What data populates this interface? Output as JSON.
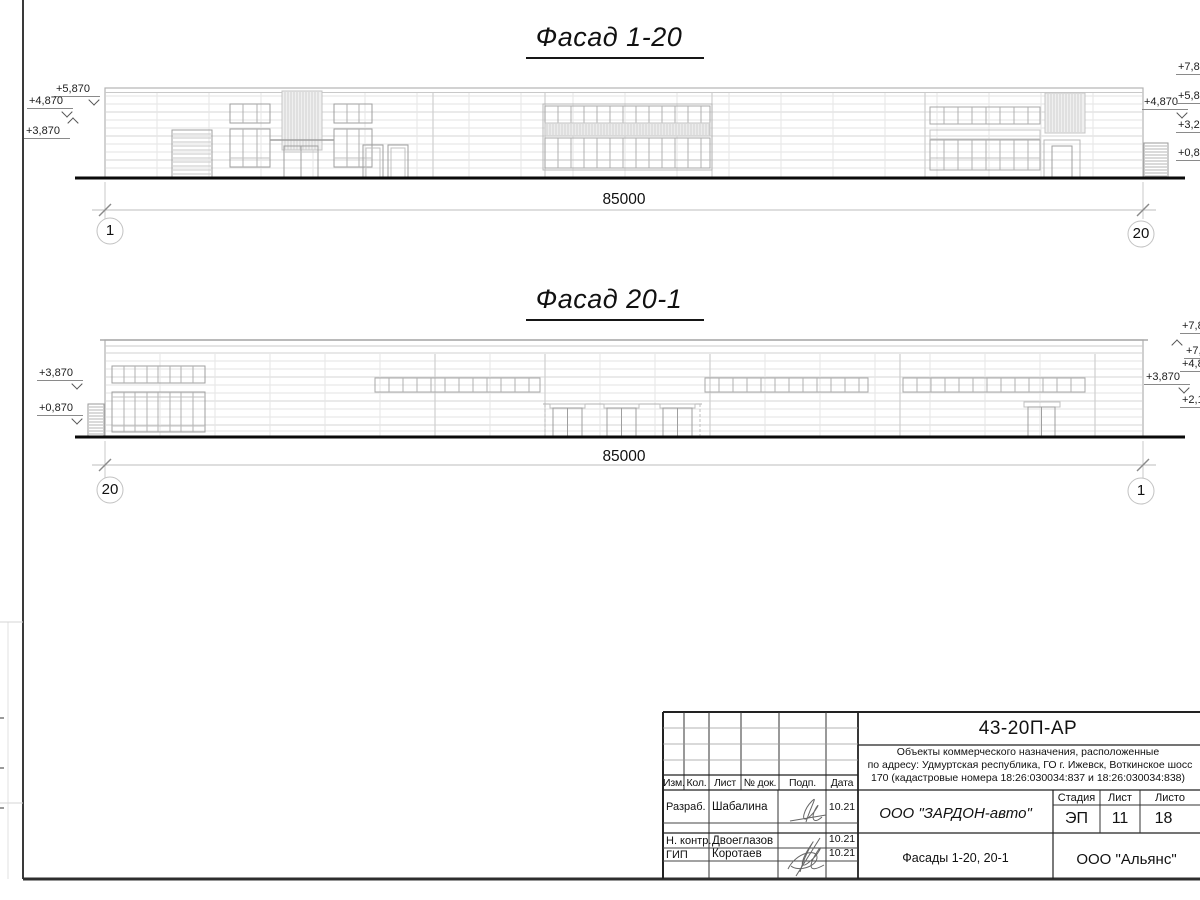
{
  "sheet": {
    "facade1": {
      "title": "Фасад 1-20",
      "dimension": "85000",
      "axis_left": "1",
      "axis_right": "20",
      "marks_left": [
        "+5,870",
        "+4,870",
        "+3,870"
      ],
      "mark_inner_right": "+4,870",
      "marks_right": [
        "+7,87",
        "+5,87",
        "+3,27",
        "+0,87"
      ]
    },
    "facade2": {
      "title": "Фасад 20-1",
      "dimension": "85000",
      "axis_left": "20",
      "axis_right": "1",
      "marks_left": [
        "+3,870",
        "+0,870"
      ],
      "mark_inner_right": "+3,870",
      "marks_right": [
        "+7,8",
        "+7,",
        "+4,8",
        "+2,1"
      ]
    },
    "titleblock": {
      "doc_number": "43-20П-АР",
      "project_lines": [
        "Объекты коммерческого назначения, расположенные",
        "по адресу: Удмуртская республика, ГО г. Ижевск, Воткинское шосс",
        "170 (кадастровые номера 18:26:030034:837 и 18:26:030034:838)"
      ],
      "columns": [
        "Изм.",
        "Кол.",
        "Лист",
        "№ док.",
        "Подп.",
        "Дата"
      ],
      "rows": [
        {
          "role": "Разраб.",
          "name": "Шабалина",
          "date": "10.21"
        },
        {
          "role": "Н. контр.",
          "name": "Двоеглазов",
          "date": "10.21"
        },
        {
          "role": "ГИП",
          "name": "Коротаев",
          "date": "10.21"
        }
      ],
      "company": "ООО \"ЗАРДОН-авто\"",
      "sheet_name": "Фасады 1-20, 20-1",
      "stage_label": "Стадия",
      "sheet_label": "Лист",
      "sheets_label": "Листо",
      "stage": "ЭП",
      "sheet": "11",
      "sheets": "18",
      "contractor": "ООО \"Альянс\""
    }
  }
}
